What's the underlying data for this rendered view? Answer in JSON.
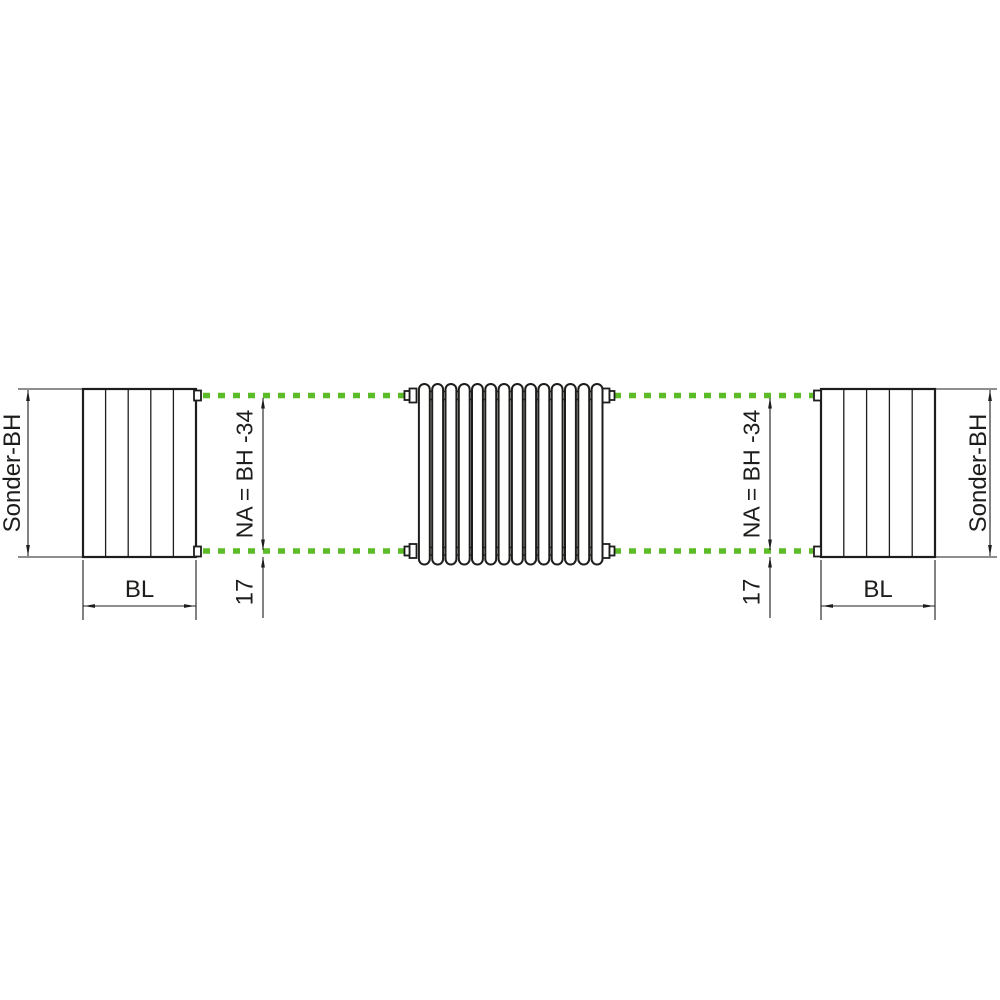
{
  "page": {
    "background": "#ffffff"
  },
  "colors": {
    "drawing_line": "#1d1d1b",
    "nipple_axis_green": "#5bbc27"
  },
  "left_side_view": {
    "height_dimension_label": "Sonder-BH",
    "width_dimension_label": "BL"
  },
  "right_side_view": {
    "height_dimension_label": "Sonder-BH",
    "width_dimension_label": "BL"
  },
  "left_axis_dimensions": {
    "nipple_distance_label": "NA = BH -34",
    "end_offset_label": "17"
  },
  "right_axis_dimensions": {
    "nipple_distance_label": "NA = BH -34",
    "end_offset_label": "17"
  },
  "radiator_front_view": {
    "tube_count": 14,
    "connection_count": 4
  }
}
